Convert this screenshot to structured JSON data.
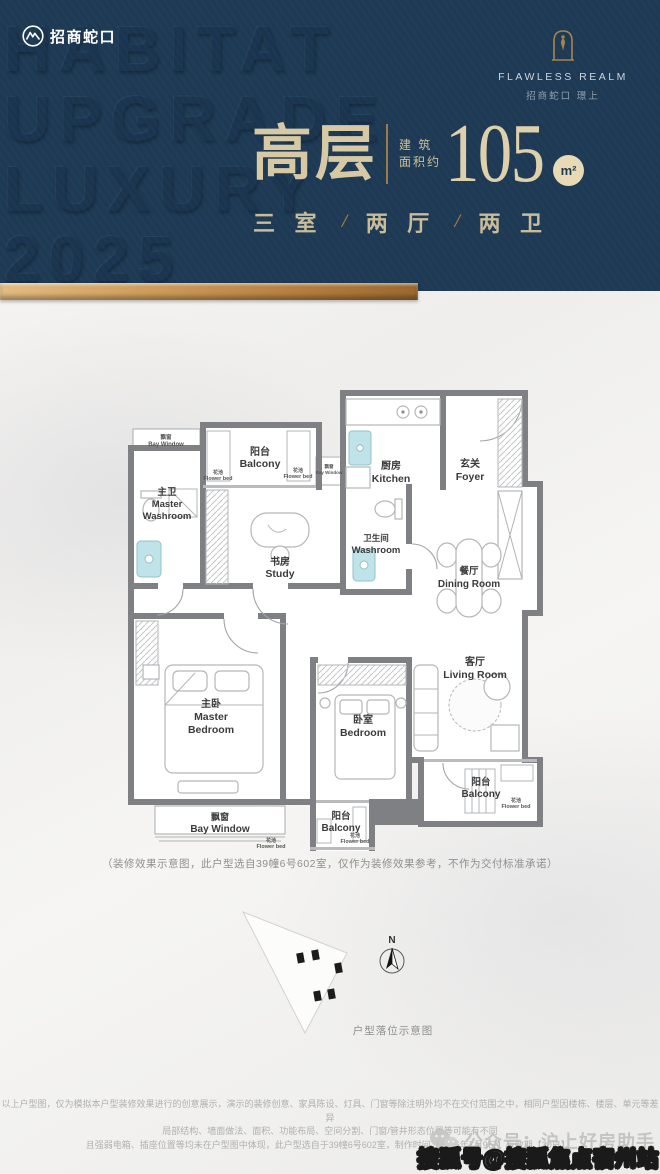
{
  "header": {
    "bg_color": "#1d3a54",
    "accent_gold": "#b98a52",
    "watermark": {
      "line1": "HABITAT",
      "line2": "UPGRADE",
      "line3": "LUXURY",
      "line4": "2025"
    },
    "brand_left": {
      "name": "招商蛇口"
    },
    "brand_right": {
      "title_en": "FLAWLESS REALM",
      "title_cn": "招商蛇口 璟上"
    },
    "headline": {
      "type_label": "高层",
      "area_prefix_line1": "建 筑",
      "area_prefix_line2": "面积约",
      "area_value": "105",
      "area_unit": "m²"
    },
    "spec": {
      "rooms": "三 室",
      "separator": "/",
      "halls": "两 厅",
      "baths": "两 卫"
    }
  },
  "floorplan": {
    "rooms": [
      {
        "cn": "阳台",
        "en": "Balcony"
      },
      {
        "cn": "飘窗",
        "en": "Bay Window"
      },
      {
        "cn": "主卫",
        "en1": "Master",
        "en2": "Washroom"
      },
      {
        "cn": "书房",
        "en": "Study"
      },
      {
        "cn": "卫生间",
        "en": "Washroom"
      },
      {
        "cn": "厨房",
        "en": "Kitchen"
      },
      {
        "cn": "玄关",
        "en": "Foyer"
      },
      {
        "cn": "餐厅",
        "en": "Dining Room"
      },
      {
        "cn": "客厅",
        "en": "Living Room"
      },
      {
        "cn": "主卧",
        "en1": "Master",
        "en2": "Bedroom"
      },
      {
        "cn": "卧室",
        "en": "Bedroom"
      },
      {
        "cn": "飘窗",
        "en": "Bay Window"
      },
      {
        "cn": "阳台",
        "en": "Balcony"
      },
      {
        "cn": "阳台",
        "en": "Balcony"
      },
      {
        "cn": "飘窗",
        "en": "Bay Window"
      }
    ],
    "flower_bed": {
      "cn": "花池",
      "en": "Flower bed"
    },
    "note": "（装修效果示意图，此户型选自39幢6号602室，仅作为装修效果参考，不作为交付标准承诺）"
  },
  "siteplan": {
    "compass_label": "N",
    "caption": "户型落位示意图"
  },
  "disclaimer": {
    "line1": "以上户型图，仅为模拟本户型装修效果进行的创意展示，演示的装修创意、家具陈设、灯具、门窗等除注明外均不在交付范围之中，相同户型因楼栋、楼层、单元等差异",
    "line2": "局部结构、墙面做法、面积、功能布局、空间分割、门窗/管井形态位置等可能有不同",
    "line3": "且强弱电箱、插座位置等均未在户型图中体现，此户型选自于39幢6号602室，制作时间【2025年7月9日】有效期【30日】。"
  },
  "watermarks": {
    "wechat_account": "公众号：沪上好房助手",
    "sohu_badge": "搜狐号@搜狐焦点宿州站"
  }
}
